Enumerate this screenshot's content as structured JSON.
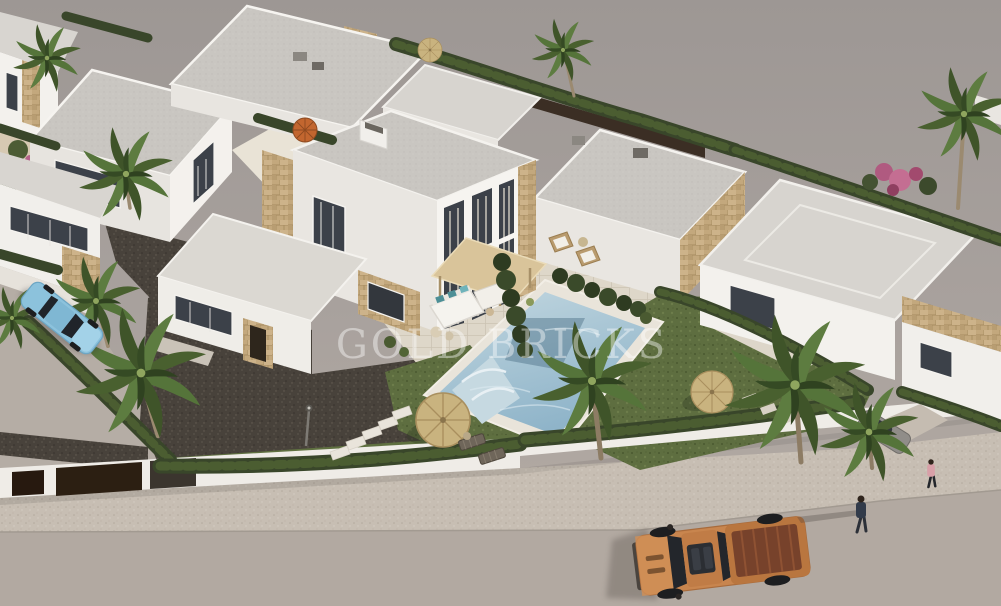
{
  "scene": {
    "type": "aerial-3d-architectural-render",
    "subject": "white modern villa development with pool, palm trees, street, pickup truck",
    "watermark": "GOLD BRICKS",
    "palette": {
      "ground_top": "#9d9794",
      "ground_bottom": "#b6ada5",
      "road": "#b2a9a1",
      "sidewalk": "#c7beb3",
      "villa_white": "#f5f3ef",
      "villa_shade": "#e9e6e1",
      "roof_gray": "#c9c6c1",
      "stone_clad": "#c3a87d",
      "hedge_green": "#39462a",
      "palm_green": "#49602f",
      "grass_green": "#5e6e40",
      "gravel_dark": "#48423b",
      "pool_blue": "#9fc2d3",
      "patio_cream": "#ded7c9",
      "pergola_tan": "#d9c49a",
      "parasol_straw": "#c9b37f",
      "parasol_orange": "#c2662f",
      "cushion_teal": "#4d8f96",
      "truck_orange": "#c8854e",
      "truck_bed": "#77422b",
      "car_blue": "#8cc2dc",
      "flower_pink": "#b85a80",
      "window_dark": "#3c4149"
    },
    "objects": {
      "main_villa": "duplex villa with curtain-wall windows, pergola and terrace",
      "pool": "swimming pool with roman steps",
      "truck": "orange pickup truck parked on street",
      "car_left": "light blue car parked on side street",
      "car_right": "gray car behind hedge",
      "people": "two pedestrians on sidewalk",
      "parasols": "straw parasols with loungers",
      "palms": "fan palm trees",
      "hedges": "dark green boundary hedges"
    }
  }
}
